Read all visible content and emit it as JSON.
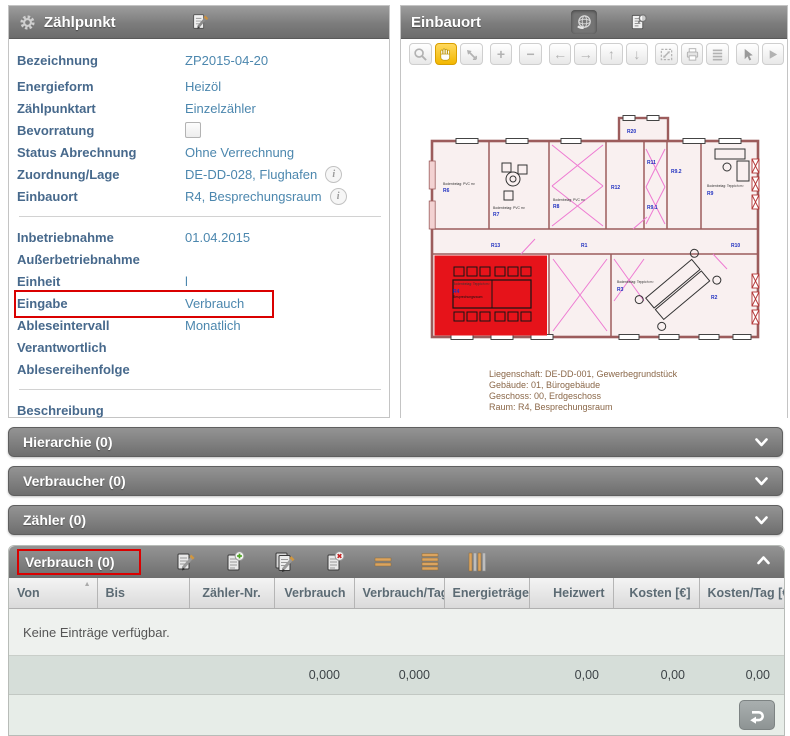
{
  "panel_zaehlpunkt": {
    "title": "Zählpunkt",
    "rows_main": [
      {
        "label": "Bezeichnung",
        "value": "ZP2015-04-20"
      },
      {
        "label": "Energieform",
        "value": "Heizöl"
      },
      {
        "label": "Zählpunktart",
        "value": "Einzelzähler"
      },
      {
        "label": "Bevorratung",
        "value": "",
        "control": "checkbox",
        "checked": false
      },
      {
        "label": "Status Abrechnung",
        "value": "Ohne Verrechnung"
      },
      {
        "label": "Zuordnung/Lage",
        "value": "DE-DD-028, Flughafen",
        "info": true
      },
      {
        "label": "Einbauort",
        "value": "R4, Besprechungsraum",
        "info": true
      }
    ],
    "rows_dates": [
      {
        "label": "Inbetriebnahme",
        "value": "01.04.2015"
      },
      {
        "label": "Außerbetriebnahme",
        "value": ""
      },
      {
        "label": "Einheit",
        "value": "l"
      },
      {
        "label": "Eingabe",
        "value": "Verbrauch",
        "highlighted": true
      },
      {
        "label": "Ableseintervall",
        "value": "Monatlich"
      },
      {
        "label": "Verantwortlich",
        "value": ""
      },
      {
        "label": "Ablesereihenfolge",
        "value": ""
      }
    ],
    "rows_bottom": [
      {
        "label": "Beschreibung",
        "value": ""
      }
    ]
  },
  "panel_einbauort": {
    "title": "Einbauort",
    "header_icons": [
      "globe-hand-icon",
      "document-search-icon"
    ],
    "toolbar": [
      "zoom-icon",
      "pan-hand-icon",
      "previous-extent-icon",
      "zoom-in-icon",
      "zoom-out-icon",
      "arrow-left-icon",
      "arrow-right-icon",
      "arrow-up-icon",
      "arrow-down-icon",
      "full-extent-icon",
      "print-icon",
      "layers-icon",
      "select-cursor-icon",
      "play-icon"
    ],
    "active_tool": "pan-hand-icon",
    "glyphs": {
      "plus": "+",
      "minus": "−",
      "left": "←",
      "right": "→",
      "up": "↑",
      "down": "↓"
    },
    "plan_caption": {
      "line1": "Liegenschaft: DE-DD-001, Gewerbegrundstück",
      "line2": "Gebäude: 01, Bürogebäude",
      "line3": "Geschoss: 00, Erdgeschoss",
      "line4": "Raum: R4, Besprechungsraum"
    },
    "room_labels": [
      "R6",
      "R7",
      "R8",
      "R12",
      "R20",
      "R11",
      "R9.2",
      "R9.1",
      "R9",
      "R13",
      "R1",
      "R10",
      "R4",
      "R3",
      "R2"
    ],
    "micro": {
      "pvc": "Bodenbelag: PVC m²",
      "teppich": "Bodenbelag: Teppich m²",
      "raum": "Besprechungsraum"
    },
    "highlight_room": "R4",
    "highlight_color": "#e6131a"
  },
  "accordions": [
    {
      "label": "Hierarchie (0)"
    },
    {
      "label": "Verbraucher (0)"
    },
    {
      "label": "Zähler (0)"
    }
  ],
  "verbrauch": {
    "title": "Verbrauch (0)",
    "toolbar": [
      "edit-icon",
      "add-icon",
      "edit-multi-icon",
      "delete-icon",
      "rows-2-icon",
      "rows-4-icon",
      "columns-icon"
    ],
    "sort_asc": "▲",
    "columns": [
      "Von",
      "Bis",
      "Zähler-Nr.",
      "Verbrauch",
      "Verbrauch/Tag",
      "Energieträger",
      "Heizwert",
      "Kosten [€]",
      "Kosten/Tag [€]"
    ],
    "empty_text": "Keine Einträge verfügbar.",
    "totals": {
      "verbrauch": "0,000",
      "verbrauch_tag": "0,000",
      "heizwert": "0,00",
      "kosten": "0,00",
      "kosten_tag": "0,00"
    }
  },
  "colors": {
    "annotation_red": "#da0000",
    "label_blue": "#47698c",
    "value_blue": "#4c87ae",
    "active_tool_yellow": "#f2b700"
  }
}
